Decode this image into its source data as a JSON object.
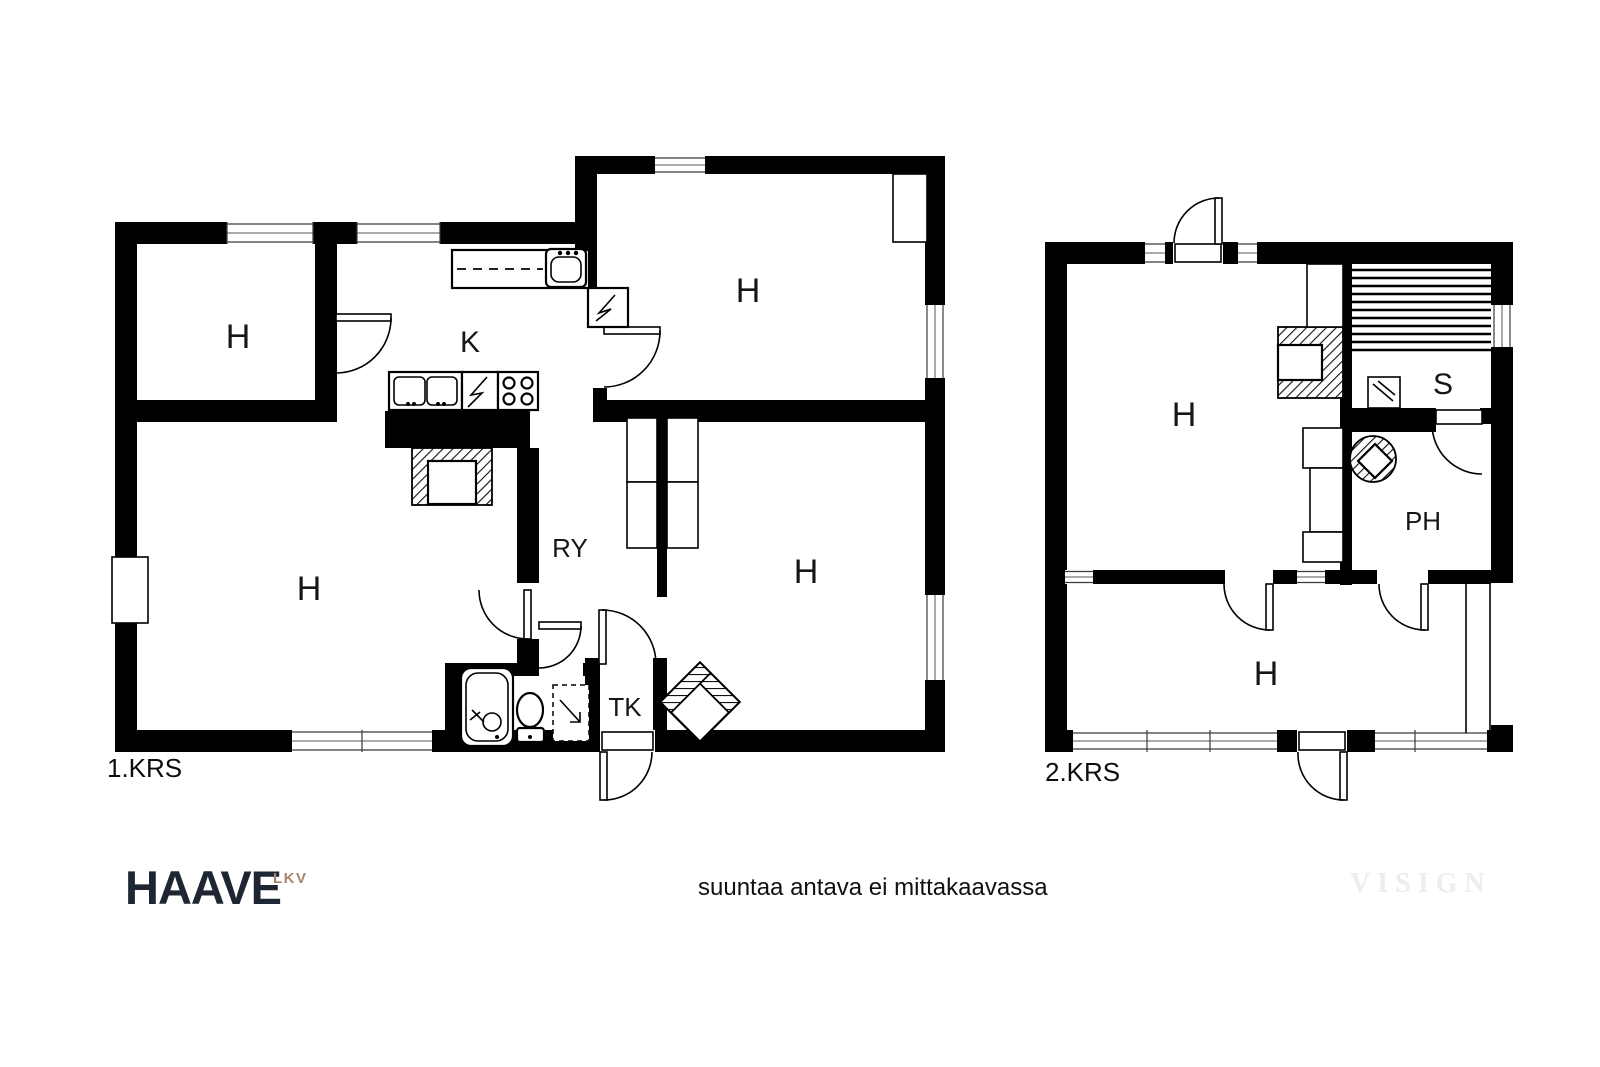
{
  "floor1": {
    "name": "1.KRS",
    "rooms": [
      {
        "label": "H"
      },
      {
        "label": "K"
      },
      {
        "label": "H"
      },
      {
        "label": "H"
      },
      {
        "label": "RY"
      },
      {
        "label": "H"
      },
      {
        "label": "TK"
      }
    ]
  },
  "floor2": {
    "name": "2.KRS",
    "rooms": [
      {
        "label": "H"
      },
      {
        "label": "S"
      },
      {
        "label": "PH"
      },
      {
        "label": "H"
      }
    ]
  },
  "footer": {
    "brand": "HAAVE",
    "brand_suffix": "LKV",
    "disclaimer": "suuntaa antava ei mittakaavassa",
    "watermark": "VISIGN"
  },
  "colors": {
    "wall": "#000000",
    "background": "#ffffff",
    "brand_dark": "#1f2633",
    "brand_tan": "#a5846a",
    "watermark_gray": "#ededed",
    "window_center": "#ababab"
  }
}
